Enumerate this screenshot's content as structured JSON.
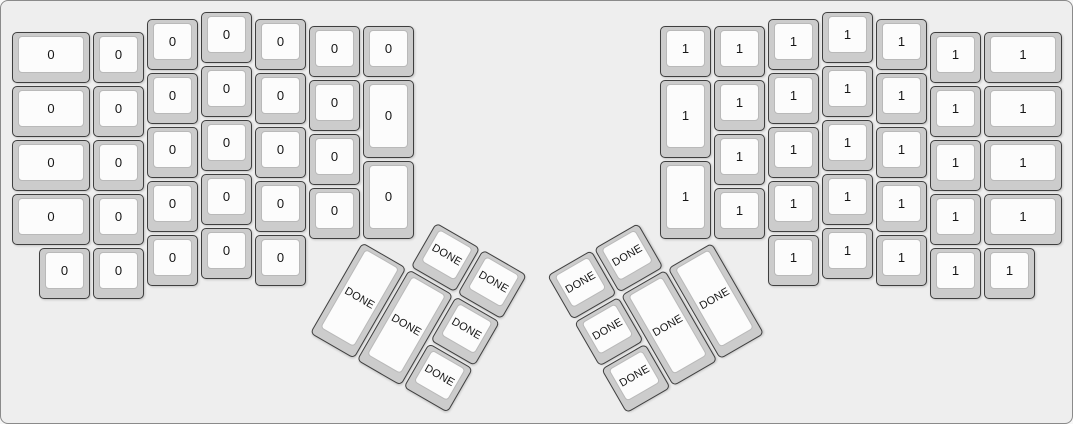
{
  "canvas": {
    "width_px": 1073,
    "height_px": 424,
    "unit_px": 54,
    "margin_px": 10,
    "background_color": "#eeeeee",
    "border_color": "#8a8a8a",
    "keycap_base_color": "#cccccc",
    "keycap_top_color": "#fcfcfc",
    "legend_color": "#161616"
  },
  "keyboard": {
    "groups": [
      {
        "name": "left-main",
        "rotation_deg": 0,
        "origin_u": [
          0,
          0
        ],
        "keys": [
          {
            "label": "0",
            "x": 0,
            "y": 0.375,
            "w": 1.5
          },
          {
            "label": "0",
            "x": 0,
            "y": 1.375,
            "w": 1.5
          },
          {
            "label": "0",
            "x": 0,
            "y": 2.375,
            "w": 1.5
          },
          {
            "label": "0",
            "x": 0,
            "y": 3.375,
            "w": 1.5
          },
          {
            "label": "0",
            "x": 1.5,
            "y": 0.375
          },
          {
            "label": "0",
            "x": 1.5,
            "y": 1.375
          },
          {
            "label": "0",
            "x": 1.5,
            "y": 2.375
          },
          {
            "label": "0",
            "x": 1.5,
            "y": 3.375
          },
          {
            "label": "0",
            "x": 0.5,
            "y": 4.375
          },
          {
            "label": "0",
            "x": 1.5,
            "y": 4.375
          },
          {
            "label": "0",
            "x": 2.5,
            "y": 0.125
          },
          {
            "label": "0",
            "x": 2.5,
            "y": 1.125
          },
          {
            "label": "0",
            "x": 2.5,
            "y": 2.125
          },
          {
            "label": "0",
            "x": 2.5,
            "y": 3.125
          },
          {
            "label": "0",
            "x": 2.5,
            "y": 4.125
          },
          {
            "label": "0",
            "x": 3.5,
            "y": 0
          },
          {
            "label": "0",
            "x": 3.5,
            "y": 1
          },
          {
            "label": "0",
            "x": 3.5,
            "y": 2
          },
          {
            "label": "0",
            "x": 3.5,
            "y": 3
          },
          {
            "label": "0",
            "x": 3.5,
            "y": 4
          },
          {
            "label": "0",
            "x": 4.5,
            "y": 0.125
          },
          {
            "label": "0",
            "x": 4.5,
            "y": 1.125
          },
          {
            "label": "0",
            "x": 4.5,
            "y": 2.125
          },
          {
            "label": "0",
            "x": 4.5,
            "y": 3.125
          },
          {
            "label": "0",
            "x": 4.5,
            "y": 4.125
          },
          {
            "label": "0",
            "x": 5.5,
            "y": 0.25
          },
          {
            "label": "0",
            "x": 5.5,
            "y": 1.25
          },
          {
            "label": "0",
            "x": 5.5,
            "y": 2.25
          },
          {
            "label": "0",
            "x": 5.5,
            "y": 3.25
          },
          {
            "label": "0",
            "x": 6.5,
            "y": 0.25
          },
          {
            "label": "0",
            "x": 6.5,
            "y": 1.25,
            "h": 1.5
          },
          {
            "label": "0",
            "x": 6.5,
            "y": 2.75,
            "h": 1.5
          }
        ]
      },
      {
        "name": "right-main",
        "rotation_deg": 0,
        "origin_u": [
          0,
          0
        ],
        "keys": [
          {
            "label": "1",
            "x": 12,
            "y": 0.25
          },
          {
            "label": "1",
            "x": 12,
            "y": 1.25,
            "h": 1.5
          },
          {
            "label": "1",
            "x": 12,
            "y": 2.75,
            "h": 1.5
          },
          {
            "label": "1",
            "x": 13,
            "y": 0.25
          },
          {
            "label": "1",
            "x": 13,
            "y": 1.25
          },
          {
            "label": "1",
            "x": 13,
            "y": 2.25
          },
          {
            "label": "1",
            "x": 13,
            "y": 3.25
          },
          {
            "label": "1",
            "x": 14,
            "y": 0.125
          },
          {
            "label": "1",
            "x": 14,
            "y": 1.125
          },
          {
            "label": "1",
            "x": 14,
            "y": 2.125
          },
          {
            "label": "1",
            "x": 14,
            "y": 3.125
          },
          {
            "label": "1",
            "x": 14,
            "y": 4.125
          },
          {
            "label": "1",
            "x": 15,
            "y": 0
          },
          {
            "label": "1",
            "x": 15,
            "y": 1
          },
          {
            "label": "1",
            "x": 15,
            "y": 2
          },
          {
            "label": "1",
            "x": 15,
            "y": 3
          },
          {
            "label": "1",
            "x": 15,
            "y": 4
          },
          {
            "label": "1",
            "x": 16,
            "y": 0.125
          },
          {
            "label": "1",
            "x": 16,
            "y": 1.125
          },
          {
            "label": "1",
            "x": 16,
            "y": 2.125
          },
          {
            "label": "1",
            "x": 16,
            "y": 3.125
          },
          {
            "label": "1",
            "x": 16,
            "y": 4.125
          },
          {
            "label": "1",
            "x": 17,
            "y": 0.375
          },
          {
            "label": "1",
            "x": 17,
            "y": 1.375
          },
          {
            "label": "1",
            "x": 17,
            "y": 2.375
          },
          {
            "label": "1",
            "x": 17,
            "y": 3.375
          },
          {
            "label": "1",
            "x": 18,
            "y": 0.375,
            "w": 1.5
          },
          {
            "label": "1",
            "x": 18,
            "y": 1.375,
            "w": 1.5
          },
          {
            "label": "1",
            "x": 18,
            "y": 2.375,
            "w": 1.5
          },
          {
            "label": "1",
            "x": 18,
            "y": 3.375,
            "w": 1.5
          },
          {
            "label": "1",
            "x": 17,
            "y": 4.375
          },
          {
            "label": "1",
            "x": 18,
            "y": 4.375
          }
        ]
      },
      {
        "name": "left-thumb",
        "rotation_deg": 30,
        "origin_u": [
          6.5,
          4.25
        ],
        "keys": [
          {
            "label": "DONE",
            "x": 1,
            "y": -1
          },
          {
            "label": "DONE",
            "x": 2,
            "y": -1
          },
          {
            "label": "DONE",
            "x": 0,
            "y": 0,
            "h": 2
          },
          {
            "label": "DONE",
            "x": 1,
            "y": 0,
            "h": 2
          },
          {
            "label": "DONE",
            "x": 2,
            "y": 0
          },
          {
            "label": "DONE",
            "x": 2,
            "y": 1
          }
        ]
      },
      {
        "name": "right-thumb",
        "rotation_deg": -30,
        "origin_u": [
          13,
          4.25
        ],
        "keys": [
          {
            "label": "DONE",
            "x": -3,
            "y": -1
          },
          {
            "label": "DONE",
            "x": -2,
            "y": -1
          },
          {
            "label": "DONE",
            "x": -3,
            "y": 0
          },
          {
            "label": "DONE",
            "x": -2,
            "y": 0,
            "h": 2
          },
          {
            "label": "DONE",
            "x": -1,
            "y": 0,
            "h": 2
          },
          {
            "label": "DONE",
            "x": -3,
            "y": 1
          }
        ]
      }
    ]
  }
}
